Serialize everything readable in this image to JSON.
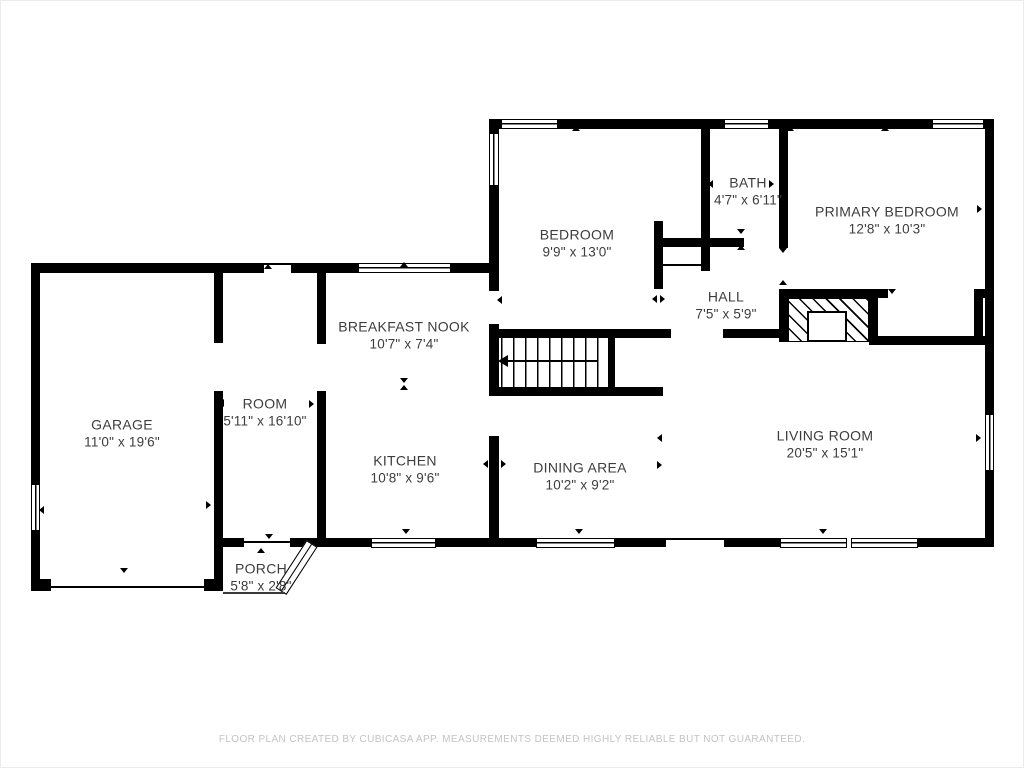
{
  "footer": {
    "disclaimer": "FLOOR PLAN CREATED BY CUBICASA APP. MEASUREMENTS DEEMED HIGHLY RELIABLE BUT NOT GUARANTEED."
  },
  "colors": {
    "wall": "#000000",
    "background": "#ffffff",
    "room_label": "#3d3d3d",
    "footer_text": "#c3c3c3"
  },
  "rooms": [
    {
      "id": "bedroom",
      "name": "BEDROOM",
      "dims": "9'9\" x 13'0\""
    },
    {
      "id": "bath",
      "name": "BATH",
      "dims": "4'7\" x 6'11\""
    },
    {
      "id": "primary-bedroom",
      "name": "PRIMARY BEDROOM",
      "dims": "12'8\" x 10'3\""
    },
    {
      "id": "hall",
      "name": "HALL",
      "dims": "7'5\" x 5'9\""
    },
    {
      "id": "breakfast-nook",
      "name": "BREAKFAST NOOK",
      "dims": "10'7\" x 7'4\""
    },
    {
      "id": "room",
      "name": "ROOM",
      "dims": "5'11\" x 16'10\""
    },
    {
      "id": "garage",
      "name": "GARAGE",
      "dims": "11'0\" x 19'6\""
    },
    {
      "id": "kitchen",
      "name": "KITCHEN",
      "dims": "10'8\" x 9'6\""
    },
    {
      "id": "dining-area",
      "name": "DINING AREA",
      "dims": "10'2\" x 9'2\""
    },
    {
      "id": "living-room",
      "name": "LIVING ROOM",
      "dims": "20'5\" x 15'1\""
    },
    {
      "id": "porch",
      "name": "PORCH",
      "dims": "5'8\" x 2'8\""
    }
  ]
}
